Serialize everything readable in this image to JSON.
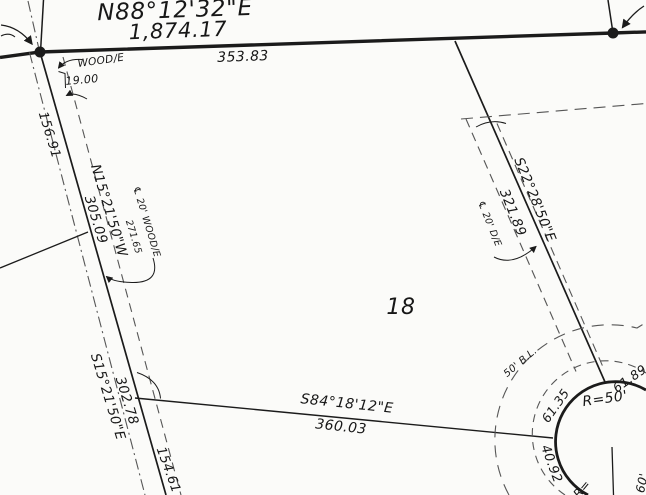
{
  "title": "Survey plat - Lot 18",
  "colors": {
    "ink": "#1b1b1b",
    "dash_gray": "#565656",
    "paper": "#fbfbf9"
  },
  "lot": {
    "number": "18"
  },
  "north_boundary": {
    "bearing": "N88°12'32\"E",
    "total_distance": "1,874.17",
    "segment_distance": "353.83"
  },
  "west_boundary": {
    "bearing": "N15°21'50\"W",
    "distance": "305.09",
    "upper_offset_distance": "156.91",
    "lower_bearing": "S15°21'50\"E",
    "lower_distance": "302.78",
    "lower_offset_distance": "154.61"
  },
  "wood_easement": {
    "tag": "WOOD/E",
    "offset": "19.00",
    "centerline_label": "℄ 20' WOOD/E",
    "centerline_distance": "271.65"
  },
  "east_boundary": {
    "bearing": "S22°28'50\"E",
    "distance": "321.89"
  },
  "drainage_easement": {
    "centerline_label": "℄ 20' D/E"
  },
  "south_boundary": {
    "bearing": "S84°18'12\"E",
    "distance": "360.03"
  },
  "cul_de_sac": {
    "radius_label": "R=50'",
    "building_line_label": "50' B.L.",
    "arc_west": "61.35",
    "arc_east": "61.89",
    "arc_south": "40.92",
    "radius_partial": "R=",
    "street_width": "60'"
  }
}
